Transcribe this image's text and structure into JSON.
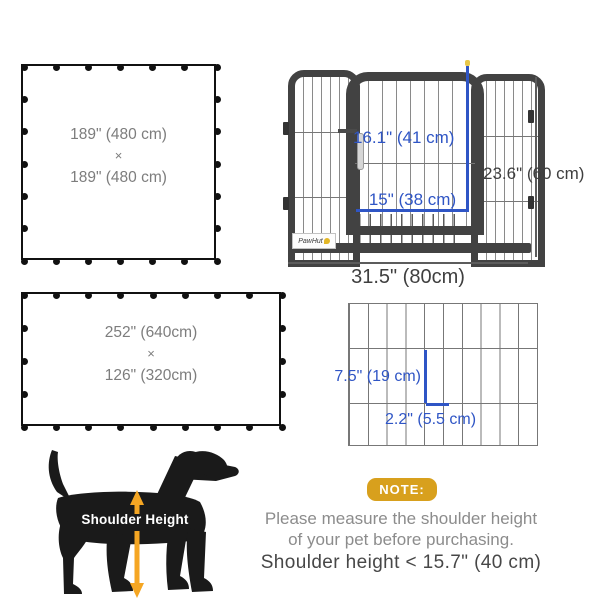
{
  "square_diagram": {
    "width_label": "189\" (480 cm)",
    "times": "×",
    "height_label": "189\" (480 cm)",
    "panels_x": 6,
    "panels_y": 6
  },
  "rect_diagram": {
    "width_label": "252\" (640cm)",
    "times": "×",
    "height_label": "126\" (320cm)",
    "panels_x": 8,
    "panels_y": 4
  },
  "playpen": {
    "brand": "PawHut",
    "door_height_label": "16.1\" (41 cm)",
    "door_width_label": "15\" (38 cm)",
    "panel_height_label": "23.6\" (60 cm)",
    "panel_width_label": "31.5\" (80cm)"
  },
  "mesh_detail": {
    "gap_height_label": "7.5\" (19 cm)",
    "bar_spacing_label": "2.2\" (5.5 cm)",
    "columns": 10,
    "rows": 3
  },
  "dog": {
    "label": "Shoulder Height"
  },
  "note": {
    "badge": "NOTE:",
    "line1": "Please measure the shoulder height",
    "line2": "of your pet before purchasing.",
    "line3": "Shoulder height < 15.7\" (40 cm)"
  },
  "colors": {
    "measure_blue": "#2f55c5",
    "frame_dark": "#424242",
    "note_gold": "#d8a01d",
    "arrow_orange": "#f5a623"
  }
}
